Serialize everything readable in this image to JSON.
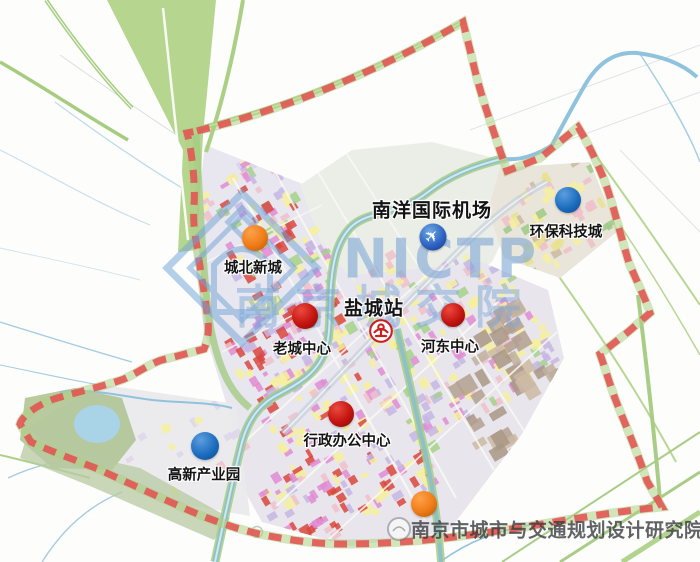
{
  "map": {
    "description": "urban-planning-map",
    "labels": [
      {
        "id": "airport-label",
        "text": "南洋国际机场",
        "x": 432,
        "y": 209,
        "bold": true
      },
      {
        "id": "station-label",
        "text": "盐城站",
        "x": 374,
        "y": 307,
        "bold": true
      },
      {
        "id": "chengbei-label",
        "text": "城北新城",
        "x": 253,
        "y": 267,
        "bold": false
      },
      {
        "id": "huanbao-label",
        "text": "环保科技城",
        "x": 566,
        "y": 231,
        "bold": false
      },
      {
        "id": "laocheng-label",
        "text": "老城中心",
        "x": 302,
        "y": 348,
        "bold": false
      },
      {
        "id": "hedong-label",
        "text": "河东中心",
        "x": 450,
        "y": 346,
        "bold": false
      },
      {
        "id": "xingzheng-label",
        "text": "行政办公中心",
        "x": 347,
        "y": 440,
        "bold": false
      },
      {
        "id": "gaoxin-label",
        "text": "高新产业园",
        "x": 204,
        "y": 474,
        "bold": false
      }
    ],
    "markers": [
      {
        "id": "chengbei-marker",
        "color": "orange",
        "x": 255,
        "y": 238,
        "r": 13
      },
      {
        "id": "laocheng-marker",
        "color": "red",
        "x": 305,
        "y": 316,
        "r": 13
      },
      {
        "id": "hedong-marker",
        "color": "red",
        "x": 453,
        "y": 315,
        "r": 12
      },
      {
        "id": "xingzheng-marker",
        "color": "red",
        "x": 341,
        "y": 414,
        "r": 13
      },
      {
        "id": "south-orange-marker",
        "color": "orange",
        "x": 424,
        "y": 504,
        "r": 13
      },
      {
        "id": "huanbao-marker",
        "color": "blue",
        "x": 568,
        "y": 200,
        "r": 13
      },
      {
        "id": "gaoxin-marker",
        "color": "blue",
        "x": 205,
        "y": 446,
        "r": 14
      }
    ],
    "icons": {
      "airport": {
        "name": "airplane-icon",
        "glyph": "✈",
        "x": 433,
        "y": 237
      },
      "railway": {
        "name": "china-railway-icon",
        "x": 381,
        "y": 331
      }
    },
    "watermarks": {
      "nictp": "NICTP",
      "short_cn": "南京城交院",
      "institute": "南京市城市与交通规划设计研究院"
    },
    "colors": {
      "boundary_red": "#e25252",
      "marker_orange": "#ee7b16",
      "marker_red": "#c41410",
      "marker_blue": "#1a6bbd",
      "corridor_green": "#aed084",
      "canal_teal": "#8fc0c8",
      "river_blue": "#a5cde0",
      "watermark_blue": "#7da7d6"
    }
  }
}
